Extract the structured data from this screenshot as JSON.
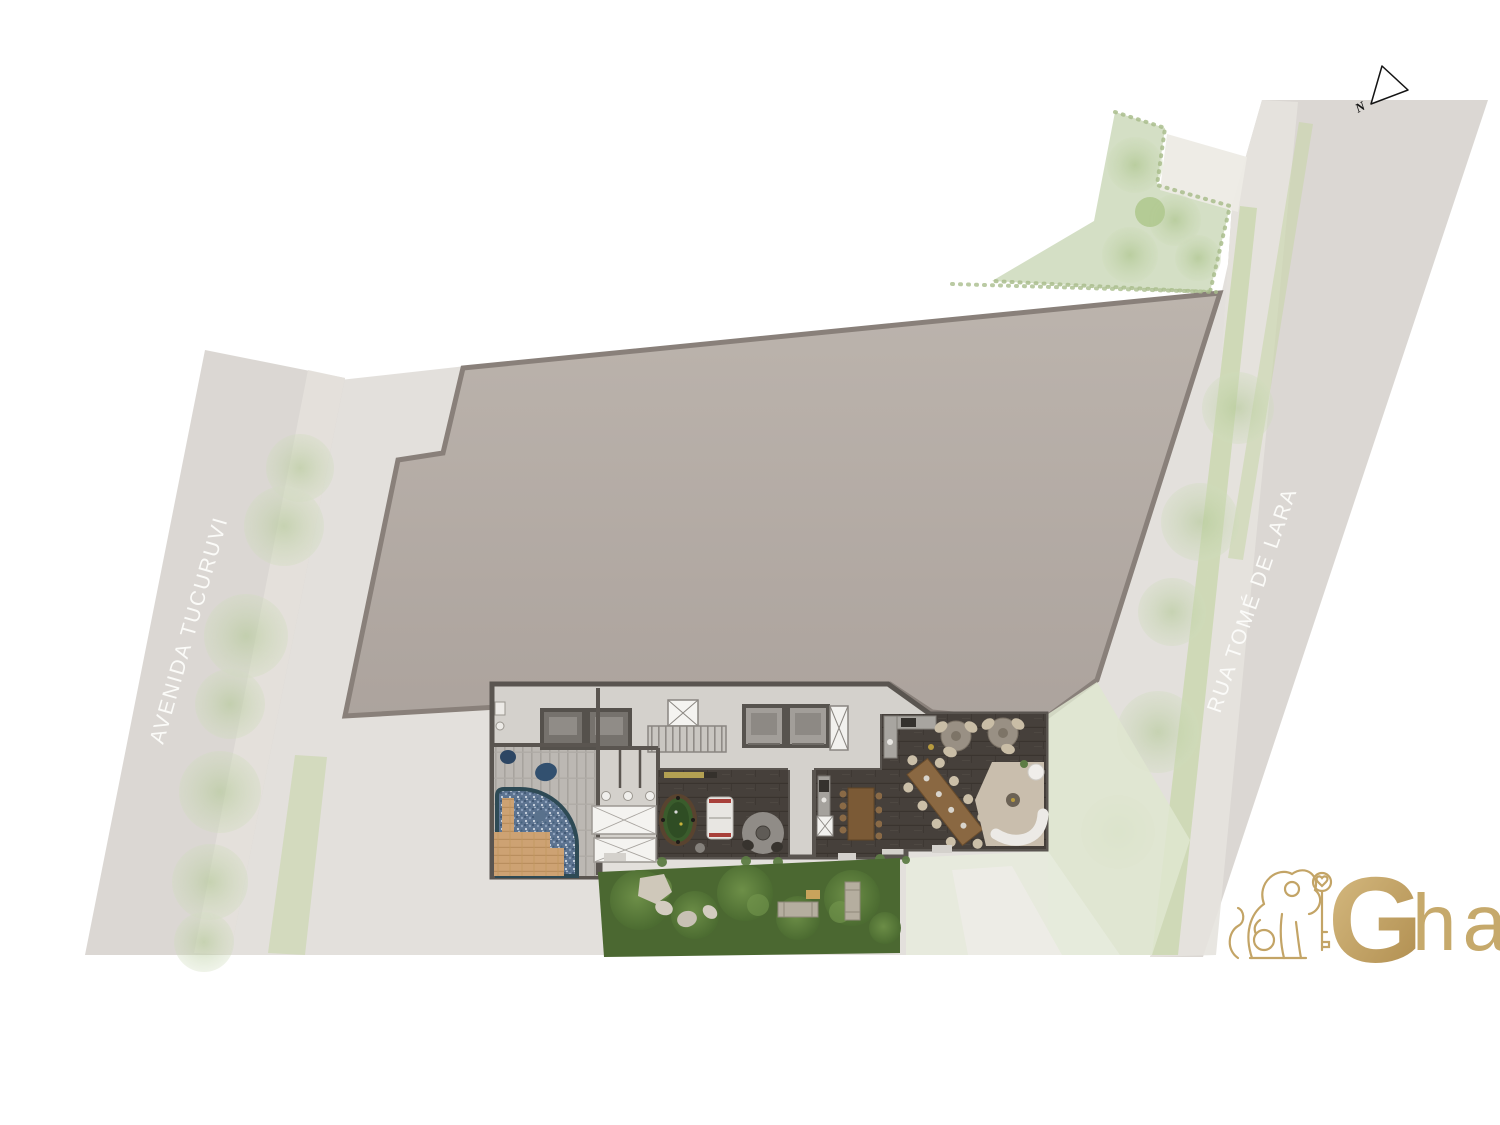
{
  "page": {
    "background": "#ffffff",
    "description": "Architectural ground-floor site plan rendering with pool, game room, party room, gardens and surrounding streets"
  },
  "streets": {
    "left": {
      "name": "AVENIDA TUCURUVI"
    },
    "right": {
      "name": "RUA TOMÉ DE LARA"
    }
  },
  "compass": {
    "label": "N"
  },
  "logo": {
    "g": "G",
    "rest": "har"
  },
  "palette": {
    "roof": "#b3aaa4",
    "roof_edge": "#89807a",
    "street": "#d7d3ce",
    "sidewalk": "#e4e1dc",
    "washed_green": "#cdd9bb",
    "verge_green": "#c6d6a6",
    "lawn_dark": "#4b6831",
    "pool_water": "#5c7390",
    "pool_edge": "#2e4a55",
    "wood_deck": "#cda273",
    "wall": "#5a5550",
    "floor_light": "#d4d1cc",
    "floor_dark": "#46403b",
    "billiard_green": "#3a5c2c",
    "logo_gold": "#c2a266"
  }
}
